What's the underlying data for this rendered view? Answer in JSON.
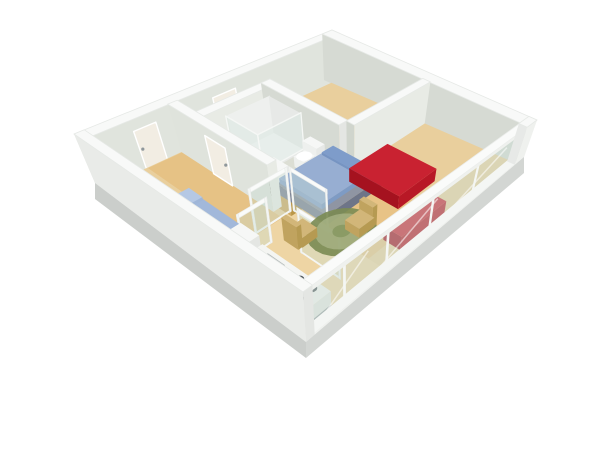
{
  "image": {
    "label": "3D perspective rendering of a one-bedroom apartment floor plan with furniture, white walls, wooden floors and a glass curtain wall",
    "width": 600,
    "height": 450,
    "background": "#ffffff"
  },
  "contents": {
    "rooms": [
      "entry-hall",
      "bathroom",
      "bedroom-left",
      "bedroom-center",
      "living-dining",
      "kitchen"
    ],
    "furniture": [
      "single-bed",
      "double-bed",
      "nightstand",
      "red-sofa",
      "red-chaise",
      "round-dining-table",
      "dining-chair",
      "kitchen-counter",
      "stove-burners",
      "kitchen-sink",
      "tall-cabinet",
      "shower-stall",
      "toilet",
      "dark-vanity",
      "vanity-sink",
      "interior-doors",
      "sliding-glass-partition"
    ]
  },
  "palette": {
    "cap": "#f8f9f8",
    "capBright": "#fafbfa",
    "innerNW": "#e0e4dd",
    "innerNE": "#d6dad3",
    "litFace": "#e8ebe5",
    "shadeFace": "#d0d5cd",
    "w1Face": "#dfe3dc",
    "outerSW": "#e9ebe8",
    "endFace": "#e4e6e3",
    "endLight": "#eff1ee",
    "plinthSW": "#cbcecb",
    "plinthSE": "#d3d6d3",
    "floorBase": "#e9cf9d",
    "floorBed": "#e8c386",
    "floorWalk": "#e6c285",
    "floorBath": "#dcded4",
    "floorDining": "#eed5a4",
    "cream": "#f2ede3",
    "white": "#f6f7f6",
    "whiteSoft": "#eef0ee",
    "grayLight": "#e7e9e7",
    "glass": "#c9dcd2",
    "glassShower": "#d8e5df",
    "framePost": "#f4f6f4",
    "railTop": "#fafbfa",
    "bedBaseTop": "#8f95a3",
    "bedBaseFu": "#6e7588",
    "bedBaseFv": "#7d8495",
    "matTop": "#97aed2",
    "matFu": "#7e9bc4",
    "matFv": "#89a3ca",
    "pilTop": "#7e9cca",
    "pilFu": "#6f8cba",
    "pilFv": "#7694c2",
    "sBaseTop": "#eceded",
    "sBaseFu": "#d9dadb",
    "sBaseFv": "#e3e4e4",
    "sMatTop": "#a2b8da",
    "sMatFu": "#8ba5cc",
    "sMatFv": "#96aed2",
    "sPilTop": "#b5c8e4",
    "sPilFu": "#9fb6d8",
    "sPilFv": "#aabfde",
    "sofaTop": "#c92231",
    "sofaFu": "#b81826",
    "sofaFv": "#a5121f",
    "ring": "#7c8c55",
    "tglass": "#b6c094",
    "tcenter": "#8a9a64",
    "chairTop": "#d2b679",
    "chairFu": "#b69a52",
    "chairFv": "#c0a35f",
    "woodTop": "#dcbd79",
    "woodFu": "#bb9749",
    "woodFv": "#cda962",
    "counterTop": "#f4f5f2",
    "counterFu": "#e6e8e4",
    "counterFv": "#edefec",
    "band": "#9aa1a4",
    "sink1": "#b4babb",
    "sink2": "#9ba1a3",
    "burner": "#4f575c",
    "vanTop": "#f2f2ef",
    "vanFu": "#3a241b",
    "vanFv": "#281811",
    "handle": "#8f979b"
  },
  "projection": {
    "plan_size": 10,
    "floor_corners": {
      "n": [
        333,
        76
      ],
      "e": [
        524,
        157
      ],
      "w": [
        95,
        183
      ],
      "s": [
        306,
        342
      ]
    },
    "top_corners": {
      "n": [
        332,
        30
      ],
      "e": [
        537,
        120
      ],
      "w": [
        74,
        134
      ],
      "s": [
        303,
        292
      ]
    },
    "plinth_drop": 16
  },
  "scene": {
    "items": [
      {
        "id": "nw-wall",
        "type": "box",
        "u0": 0,
        "v0": 0,
        "u1": 0.38,
        "v1": 10,
        "t0": 0,
        "t1": 1,
        "top": "cap",
        "fu": "innerNW",
        "fv": "endFace",
        "st": "#e6e9e6"
      },
      {
        "id": "ne-wall",
        "type": "box",
        "u0": 0,
        "v0": 0,
        "u1": 10,
        "v1": 0.38,
        "t0": 0,
        "t1": 1,
        "top": "cap",
        "fu": "endLight",
        "fv": "innerNE",
        "st": "#e6e9e6"
      },
      {
        "id": "entrance-door",
        "type": "vpanel",
        "axis": "u",
        "c": 0.4,
        "a0": 4.15,
        "a1": 5.05,
        "t0": 0,
        "t1": 0.78,
        "f": "cream",
        "st": "#ffffff"
      },
      {
        "id": "entrance-door-handle",
        "type": "dot",
        "u": 0.42,
        "v": 4.95,
        "t": 0.4,
        "r": 1.6,
        "f": "handle"
      },
      {
        "id": "bedroom-door",
        "type": "vpanel",
        "axis": "u",
        "c": 0.4,
        "a0": 7.3,
        "a1": 8.18,
        "t0": 0,
        "t1": 0.78,
        "f": "cream",
        "st": "#ffffff"
      },
      {
        "id": "bedroom-door-handle",
        "type": "dot",
        "u": 0.42,
        "v": 8.08,
        "t": 0.4,
        "r": 1.6,
        "f": "handle"
      },
      {
        "id": "floor-base",
        "type": "floor",
        "u0": 0.35,
        "v0": 0.35,
        "u1": 9.66,
        "v1": 9.66,
        "f": "floorBase"
      },
      {
        "id": "floor-bedroom-center",
        "type": "floor",
        "u0": 4.85,
        "v0": 3.4,
        "u1": 9.0,
        "v1": 6.2,
        "f": "floorBed"
      },
      {
        "id": "floor-hallway",
        "type": "floor",
        "u0": 0.38,
        "v0": 6.67,
        "u1": 5.3,
        "v1": 8.1,
        "f": "floorWalk"
      },
      {
        "id": "floor-bathroom",
        "type": "floor",
        "u0": 1.55,
        "v0": 3.78,
        "u1": 4.85,
        "v1": 6.3,
        "f": "floorBath"
      },
      {
        "id": "floor-dining",
        "type": "floor",
        "u0": 5.3,
        "v0": 6.2,
        "u1": 9.66,
        "v1": 9.62,
        "f": "floorDining"
      },
      {
        "id": "bathroom-wall-west",
        "type": "box",
        "u0": 1.2,
        "v0": 3.4,
        "u1": 1.55,
        "v1": 6.3,
        "t0": 0,
        "t1": 1,
        "top": "cap",
        "fu": "litFace",
        "fv": "shadeFace",
        "st": "#e6e9e6"
      },
      {
        "id": "bathroom-wall-north",
        "type": "box",
        "u0": 1.2,
        "v0": 3.4,
        "u1": 4.85,
        "v1": 3.75,
        "t0": 0,
        "t1": 1,
        "top": "cap",
        "fu": "endFace",
        "fv": "innerNE",
        "st": "#e6e9e6"
      },
      {
        "id": "shower-tray",
        "type": "box",
        "u0": 1.6,
        "v0": 3.8,
        "u1": 3.1,
        "v1": 5.55,
        "t0": 0,
        "t1": 0.055,
        "top": "white",
        "fu": "grayLight",
        "fv": "whiteSoft"
      },
      {
        "id": "shower-back-panel",
        "type": "vpanel",
        "axis": "u",
        "c": 1.64,
        "a0": 3.8,
        "a1": 5.5,
        "t0": 0.05,
        "t1": 0.85,
        "f": "whiteSoft"
      },
      {
        "id": "shower-side-panel",
        "type": "vpanel",
        "axis": "v",
        "c": 3.84,
        "a0": 1.62,
        "a1": 3.1,
        "t0": 0.05,
        "t1": 0.85,
        "f": "grayLight"
      },
      {
        "id": "shower-glass-right",
        "type": "vpanel",
        "axis": "u",
        "c": 3.1,
        "a0": 3.8,
        "a1": 5.55,
        "t0": 0.05,
        "t1": 0.84,
        "f": "glassShower",
        "op": 0.5,
        "st": "#f5f7f5"
      },
      {
        "id": "shower-glass-front",
        "type": "vpanel",
        "axis": "v",
        "c": 5.55,
        "a0": 1.62,
        "a1": 3.1,
        "t0": 0.05,
        "t1": 0.84,
        "f": "glassShower",
        "op": 0.5,
        "st": "#f5f7f5"
      },
      {
        "id": "toilet-tank",
        "type": "box",
        "u0": 3.45,
        "v0": 3.78,
        "u1": 4.15,
        "v1": 4.12,
        "t0": 0.14,
        "t1": 0.4,
        "top": "white",
        "fu": "grayLight",
        "fv": "whiteSoft"
      },
      {
        "id": "toilet-bowl",
        "type": "box",
        "u0": 3.55,
        "v0": 4.12,
        "u1": 4.05,
        "v1": 4.6,
        "t0": 0,
        "t1": 0.22,
        "top": "white",
        "fu": "grayLight",
        "fv": "whiteSoft"
      },
      {
        "id": "toilet-seat",
        "type": "disk",
        "cu": 3.8,
        "cv": 4.36,
        "r": 0.26,
        "t": 0.225,
        "f": "#ffffff"
      },
      {
        "id": "bathroom-vanity",
        "type": "box",
        "u0": 3.1,
        "v0": 5.5,
        "u1": 4.78,
        "v1": 6.3,
        "t0": 0.1,
        "t1": 0.45,
        "top": "vanTop",
        "fu": "vanFu",
        "fv": "vanFv"
      },
      {
        "id": "vanity-sink",
        "type": "box",
        "u0": 3.8,
        "v0": 5.58,
        "u1": 4.5,
        "v1": 6.08,
        "t0": 0.45,
        "t1": 0.56,
        "top": "white",
        "fu": "grayLight",
        "fv": "whiteSoft"
      },
      {
        "id": "partition-wall",
        "type": "box",
        "u0": 4.85,
        "v0": 0.35,
        "u1": 5.22,
        "v1": 3.45,
        "t0": 0,
        "t1": 1,
        "top": "cap",
        "fu": "litFace",
        "fv": "shadeFace",
        "st": "#e6e9e6"
      },
      {
        "id": "nightstand",
        "type": "box",
        "u0": 4.8,
        "v0": 5.75,
        "u1": 5.45,
        "v1": 6.42,
        "t0": 0,
        "t1": 0.33,
        "top": "woodTop",
        "fu": "woodFu",
        "fv": "woodFv"
      },
      {
        "id": "double-bed-base",
        "type": "box",
        "u0": 4.25,
        "v0": 3.55,
        "u1": 6.7,
        "v1": 5.95,
        "t0": 0,
        "t1": 0.21,
        "top": "bedBaseTop",
        "fu": "bedBaseFu",
        "fv": "bedBaseFv"
      },
      {
        "id": "double-bed-mattress",
        "type": "box",
        "u0": 4.3,
        "v0": 3.6,
        "u1": 6.35,
        "v1": 5.85,
        "t0": 0.21,
        "t1": 0.32,
        "top": "matTop",
        "fu": "matFu",
        "fv": "matFv"
      },
      {
        "id": "double-bed-pillow",
        "type": "box",
        "u0": 4.38,
        "v0": 3.62,
        "u1": 6.25,
        "v1": 4.1,
        "t0": 0.32,
        "t1": 0.38,
        "top": "pilTop",
        "fu": "pilFu",
        "fv": "pilFv"
      },
      {
        "id": "hall-wall",
        "type": "box",
        "u0": 0.35,
        "v0": 6.3,
        "u1": 4.85,
        "v1": 6.67,
        "t0": 0,
        "t1": 1,
        "top": "cap",
        "fu": "litFace",
        "fv": "w1Face",
        "st": "#e6e9e6"
      },
      {
        "id": "bathroom-door",
        "type": "vpanel",
        "axis": "v",
        "c": 6.69,
        "a0": 1.95,
        "a1": 2.88,
        "t0": 0,
        "t1": 0.8,
        "f": "cream",
        "st": "#ffffff"
      },
      {
        "id": "bathroom-door-handle",
        "type": "dot",
        "u": 2.78,
        "v": 6.72,
        "t": 0.42,
        "r": 1.6,
        "f": "handle"
      },
      {
        "id": "sofa-main",
        "type": "box",
        "u0": 5.6,
        "v0": 2.35,
        "u1": 8.05,
        "v1": 4.0,
        "t0": 0,
        "t1": 0.3,
        "top": "sofaTop",
        "fu": "sofaFu",
        "fv": "sofaFv"
      },
      {
        "id": "sofa-chaise",
        "type": "box",
        "u0": 8.75,
        "v0": 3.3,
        "u1": 9.6,
        "v1": 5.3,
        "t0": 0,
        "t1": 0.3,
        "top": "sofaTop",
        "fu": "sofaFu",
        "fv": "sofaFv"
      },
      {
        "id": "glass-slider-a1",
        "type": "slider",
        "axis": "v",
        "c": 6.2,
        "a0": 5.3,
        "a1": 7.05
      },
      {
        "id": "glass-slider-a2",
        "type": "slider",
        "axis": "v",
        "c": 7.42,
        "a0": 7.0,
        "a1": 8.95
      },
      {
        "id": "glass-slider-b1",
        "type": "slider",
        "axis": "u",
        "c": 5.27,
        "a0": 6.25,
        "a1": 7.85
      },
      {
        "id": "glass-slider-b2",
        "type": "slider",
        "axis": "u",
        "c": 5.95,
        "a0": 7.7,
        "a1": 8.95
      },
      {
        "id": "dining-table-ring",
        "type": "disk",
        "cu": 7.8,
        "cv": 6.3,
        "r": 1.15,
        "t": 0.29,
        "f": "ring",
        "op": 0.92
      },
      {
        "id": "dining-table-glass",
        "type": "disk",
        "cu": 7.8,
        "cv": 6.3,
        "r": 0.86,
        "t": 0.3,
        "f": "tglass",
        "op": 0.6
      },
      {
        "id": "dining-table-center",
        "type": "disk",
        "cu": 7.8,
        "cv": 6.3,
        "r": 0.3,
        "t": 0.305,
        "f": "tcenter",
        "op": 0.95
      },
      {
        "id": "dining-chair-2-back",
        "type": "box",
        "u0": 7.35,
        "v0": 4.92,
        "u1": 8.0,
        "v1": 5.12,
        "t0": 0,
        "t1": 0.45,
        "top": "chairTop",
        "fu": "chairFu",
        "fv": "chairFv"
      },
      {
        "id": "dining-chair-2-seat",
        "type": "box",
        "u0": 7.32,
        "v0": 5.05,
        "u1": 8.02,
        "v1": 5.72,
        "t0": 0,
        "t1": 0.2,
        "top": "chairTop",
        "fu": "chairFu",
        "fv": "chairFv"
      },
      {
        "id": "dining-chair-1-seat",
        "type": "box",
        "u0": 6.18,
        "v0": 6.55,
        "u1": 6.88,
        "v1": 7.22,
        "t0": 0,
        "t1": 0.2,
        "top": "chairTop",
        "fu": "chairFu",
        "fv": "chairFv"
      },
      {
        "id": "dining-chair-1-back",
        "type": "box",
        "u0": 6.15,
        "v0": 7.18,
        "u1": 6.85,
        "v1": 7.38,
        "t0": 0,
        "t1": 0.48,
        "top": "chairTop",
        "fu": "chairFu",
        "fv": "chairFv"
      },
      {
        "id": "single-bed-base",
        "type": "box",
        "u0": 2.6,
        "v0": 8.15,
        "u1": 5.5,
        "v1": 9.6,
        "t0": 0,
        "t1": 0.17,
        "top": "sBaseTop",
        "fu": "sBaseFu",
        "fv": "sBaseFv"
      },
      {
        "id": "single-bed-mattress",
        "type": "box",
        "u0": 2.68,
        "v0": 8.22,
        "u1": 5.15,
        "v1": 9.52,
        "t0": 0.17,
        "t1": 0.27,
        "top": "sMatTop",
        "fu": "sMatFu",
        "fv": "sMatFv"
      },
      {
        "id": "single-bed-pillow",
        "type": "box",
        "u0": 2.72,
        "v0": 8.25,
        "u1": 3.35,
        "v1": 9.5,
        "t0": 0.27,
        "t1": 0.33,
        "top": "sPilTop",
        "fu": "sPilFu",
        "fv": "sPilFv"
      },
      {
        "id": "tall-cabinet",
        "type": "box",
        "u0": 5.5,
        "v0": 8.5,
        "u1": 6.35,
        "v1": 9.6,
        "t0": 0,
        "t1": 0.52,
        "top": "white",
        "fu": "endFace",
        "fv": "whiteSoft"
      },
      {
        "id": "kitchen-counter",
        "type": "box",
        "u0": 6.45,
        "v0": 8.5,
        "u1": 9.64,
        "v1": 9.6,
        "t0": 0,
        "t1": 0.37,
        "top": "counterTop",
        "fu": "counterFu",
        "fv": "counterFv"
      },
      {
        "id": "kitchen-counter-base-band",
        "type": "vpanel",
        "axis": "u",
        "c": 9.65,
        "a0": 8.5,
        "a1": 9.6,
        "t0": 0,
        "t1": 0.1,
        "f": "band"
      },
      {
        "id": "kitchen-sink",
        "type": "box",
        "u0": 6.9,
        "v0": 8.68,
        "u1": 7.7,
        "v1": 9.3,
        "t0": 0.37,
        "t1": 0.378,
        "top": "sink1",
        "fu": "sink1",
        "fv": "sink1"
      },
      {
        "id": "kitchen-sink-basin",
        "type": "box",
        "u0": 7.0,
        "v0": 8.76,
        "u1": 7.6,
        "v1": 9.22,
        "t0": 0.378,
        "t1": 0.382,
        "top": "sink2",
        "fu": "sink2",
        "fv": "sink2"
      },
      {
        "id": "stove-burner-1",
        "type": "disk",
        "cu": 8.5,
        "cv": 8.82,
        "r": 0.17,
        "t": 0.378,
        "f": "burner"
      },
      {
        "id": "stove-burner-2",
        "type": "disk",
        "cu": 8.5,
        "cv": 9.28,
        "r": 0.17,
        "t": 0.378,
        "f": "burner"
      },
      {
        "id": "stove-burner-3",
        "type": "disk",
        "cu": 9.1,
        "cv": 8.82,
        "r": 0.17,
        "t": 0.378,
        "f": "burner"
      },
      {
        "id": "stove-burner-4",
        "type": "disk",
        "cu": 9.1,
        "cv": 9.28,
        "r": 0.17,
        "t": 0.378,
        "f": "burner"
      },
      {
        "id": "glass-wall-pane",
        "type": "vpanel",
        "axis": "u",
        "c": 9.84,
        "a0": 0.4,
        "a1": 9.6,
        "t0": 0.04,
        "t1": 0.9,
        "f": "glass",
        "op": 0.45
      },
      {
        "id": "glass-reflection-1",
        "type": "line",
        "p": [
          10,
          1.2,
          0.82
        ],
        "q": [
          10,
          4.4,
          0.12
        ],
        "st": "#ffffff",
        "w": 1.5,
        "op": 0.55
      },
      {
        "id": "glass-reflection-2",
        "type": "line",
        "p": [
          10,
          4.2,
          0.85
        ],
        "q": [
          10,
          7.6,
          0.1
        ],
        "st": "#ffffff",
        "w": 1.5,
        "op": 0.55
      },
      {
        "id": "glass-reflection-3",
        "type": "line",
        "p": [
          10,
          7.2,
          0.85
        ],
        "q": [
          10,
          9.5,
          0.15
        ],
        "st": "#ffffff",
        "w": 1.5,
        "op": 0.55
      },
      {
        "id": "glass-wall-post-1",
        "type": "vpanel",
        "axis": "u",
        "c": 9.82,
        "a0": 2.2,
        "a1": 2.32,
        "t0": 0.03,
        "t1": 0.9,
        "f": "framePost"
      },
      {
        "id": "glass-wall-post-2",
        "type": "vpanel",
        "axis": "u",
        "c": 9.82,
        "a0": 4.15,
        "a1": 4.27,
        "t0": 0.03,
        "t1": 0.9,
        "f": "framePost"
      },
      {
        "id": "glass-wall-post-3",
        "type": "vpanel",
        "axis": "u",
        "c": 9.82,
        "a0": 6.1,
        "a1": 6.22,
        "t0": 0.03,
        "t1": 0.9,
        "f": "framePost"
      },
      {
        "id": "glass-wall-post-4",
        "type": "vpanel",
        "axis": "u",
        "c": 9.82,
        "a0": 8.0,
        "a1": 8.12,
        "t0": 0.03,
        "t1": 0.9,
        "f": "framePost"
      },
      {
        "id": "glass-wall-cap",
        "type": "box",
        "u0": 9.62,
        "v0": 0.35,
        "u1": 10,
        "v1": 10,
        "t0": 0.9,
        "t1": 1,
        "top": "capBright",
        "fu": "endLight",
        "fv": "whiteSoft",
        "st": "#eceeec"
      },
      {
        "id": "glass-wall-bottom-rail",
        "type": "box",
        "u0": 9.62,
        "v0": 0.35,
        "u1": 10,
        "v1": 10,
        "t0": 0,
        "t1": 0.05,
        "top": "framePost",
        "fu": "endLight",
        "fv": "framePost"
      },
      {
        "id": "corner-post-east",
        "type": "box",
        "u0": 9.6,
        "v0": 0,
        "u1": 10,
        "v1": 0.42,
        "t0": 0,
        "t1": 1,
        "top": "cap",
        "fu": "endLight",
        "fv": "grayLight",
        "st": "#e6e9e6"
      },
      {
        "id": "sw-wall",
        "type": "box",
        "u0": 0,
        "v0": 9.6,
        "u1": 10,
        "v1": 10,
        "t0": 0,
        "t1": 1,
        "top": "cap",
        "fu": "endFace",
        "fv": "outerSW",
        "st": "#e6e9e6"
      },
      {
        "id": "base-slab-sw",
        "type": "plinth",
        "which": "sw",
        "f": "plinthSW"
      },
      {
        "id": "base-slab-se",
        "type": "plinth",
        "which": "se",
        "f": "plinthSE"
      }
    ]
  }
}
